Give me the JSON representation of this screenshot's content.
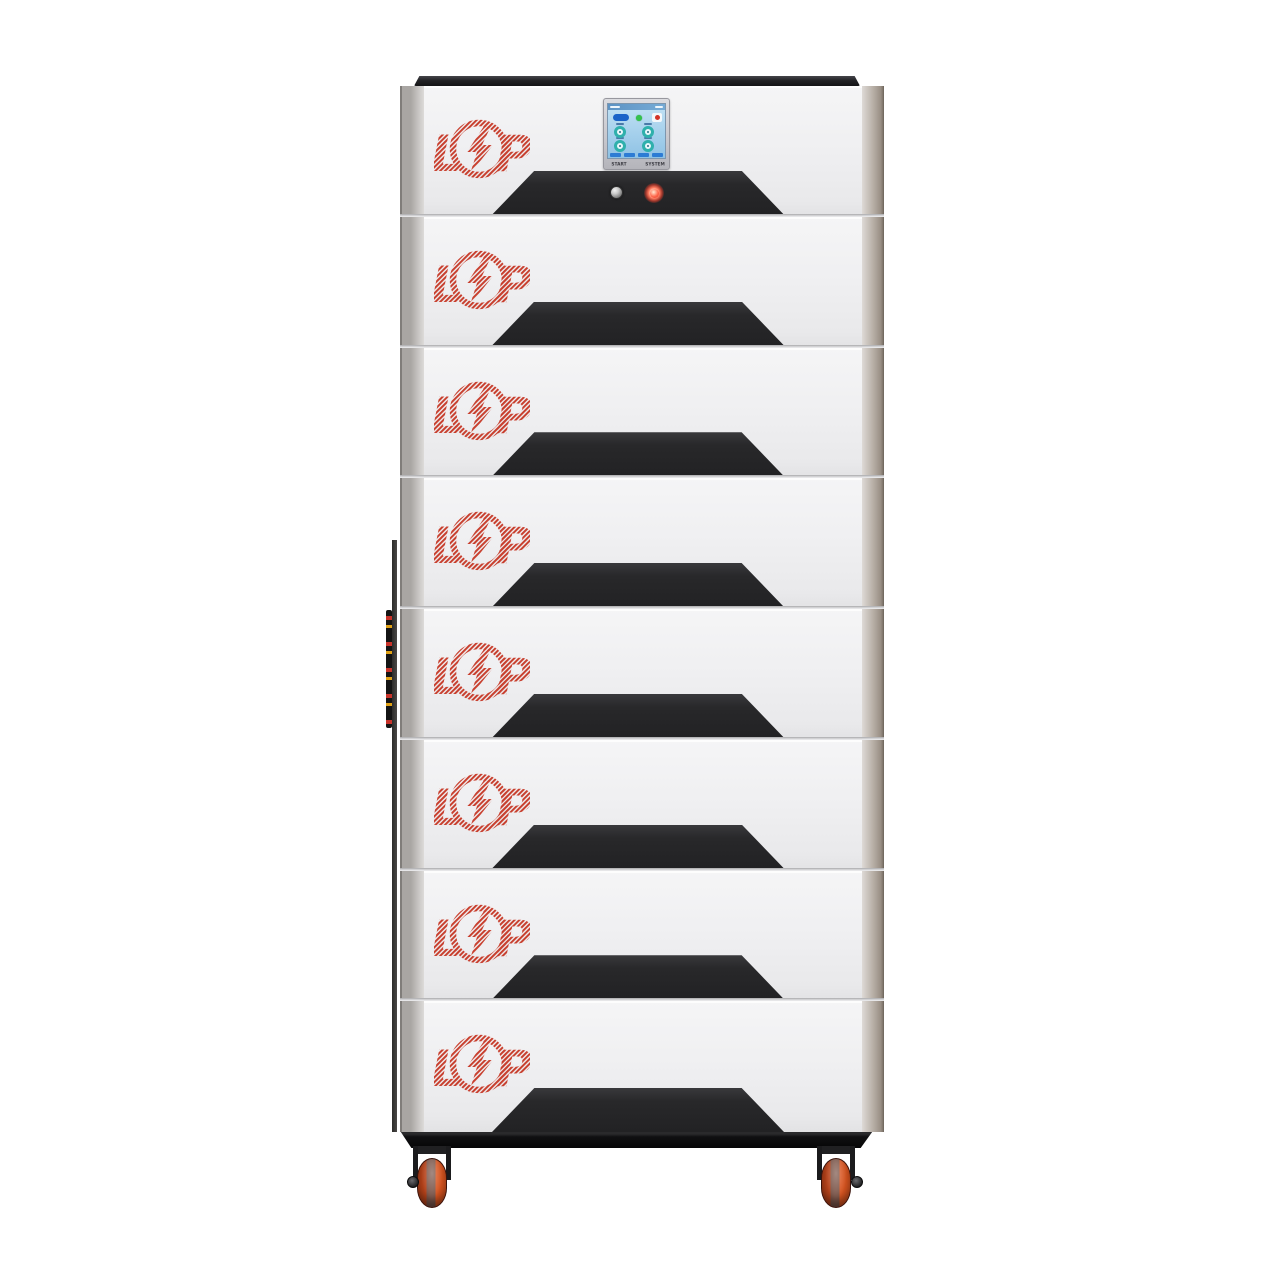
{
  "product": {
    "name": "LP stacked battery energy storage tower",
    "module_count": 8,
    "modules": [
      {
        "type": "control"
      },
      {
        "type": "battery"
      },
      {
        "type": "battery"
      },
      {
        "type": "battery"
      },
      {
        "type": "battery"
      },
      {
        "type": "battery"
      },
      {
        "type": "battery"
      },
      {
        "type": "battery"
      }
    ]
  },
  "logo": {
    "letter_l": "L",
    "letter_p": "P",
    "symbol": "lightning-bolt-in-circle",
    "color": "#c8402f"
  },
  "control_panel": {
    "start_label": "START",
    "system_label": "SYSTEM",
    "power_button": "metallic-round-button",
    "status_led_color": "#ff4434",
    "screen": {
      "background": "#9ecbe9",
      "icons": [
        "mode-pill",
        "ok-indicator",
        "alarm-icon",
        "gauge",
        "gauge",
        "gauge",
        "gauge",
        "menu-buttons"
      ]
    }
  },
  "colors": {
    "face": "#efeff1",
    "handle_recess": "#28282a",
    "top_cap": "#1d1d1f",
    "plinth": "#0e0e10",
    "wheel_orange": "#d8541f",
    "bevel_right": "#998f85"
  }
}
